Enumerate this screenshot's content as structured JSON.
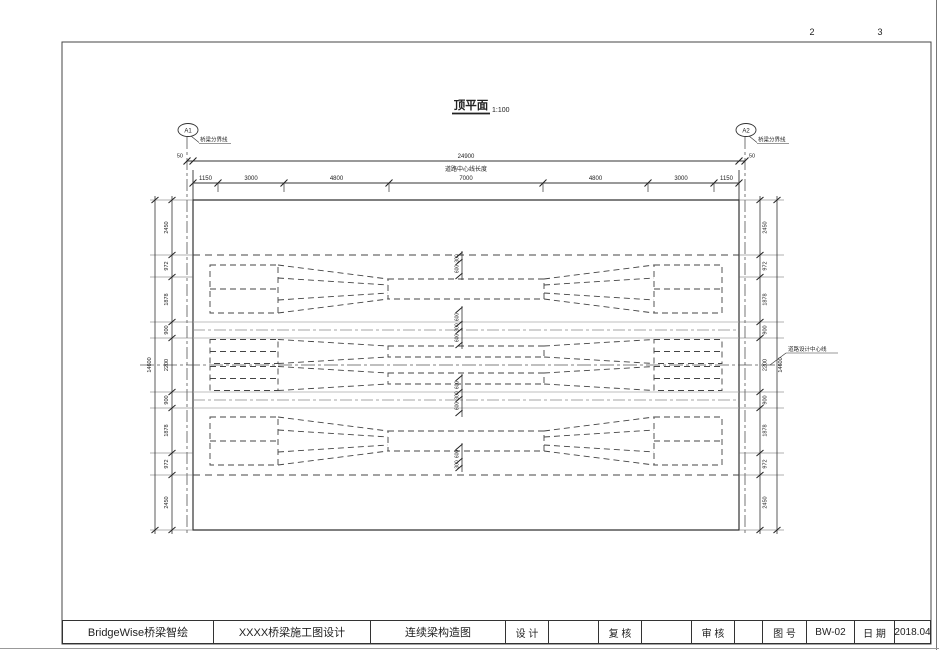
{
  "sheet": {
    "page_numbers": [
      "2",
      "3"
    ]
  },
  "view": {
    "title": "顶平面",
    "scale": "1:100"
  },
  "axes": {
    "left_label": "A1",
    "right_label": "A2",
    "leader_text": "桥梁分界线"
  },
  "dims": {
    "bearing_offset": "50",
    "total_length": "24900",
    "total_caption": "道路中心线长度",
    "top_segments": [
      "1150",
      "3000",
      "4800",
      "7000",
      "4800",
      "3000",
      "1150"
    ],
    "side_segments": [
      "2450",
      "972",
      "1878",
      "900",
      "2200",
      "900",
      "1878",
      "972",
      "2450"
    ],
    "side_total": "14600",
    "mid_stacks": [
      [
        "300",
        "600"
      ],
      [
        "600",
        "300",
        "600"
      ],
      [
        "600",
        "300",
        "600"
      ],
      [
        "600",
        "300"
      ]
    ],
    "centerline_label": "道路设计中心线"
  },
  "title_block": {
    "company": "BridgeWise桥梁智绘",
    "project": "XXXX桥梁施工图设计",
    "drawing_title": "连续梁构造图",
    "design_label": "设 计",
    "check_label": "复 核",
    "audit_label": "审 核",
    "fig_no_label": "图 号",
    "fig_no": "BW-02",
    "date_label": "日 期",
    "date": "2018.04"
  }
}
